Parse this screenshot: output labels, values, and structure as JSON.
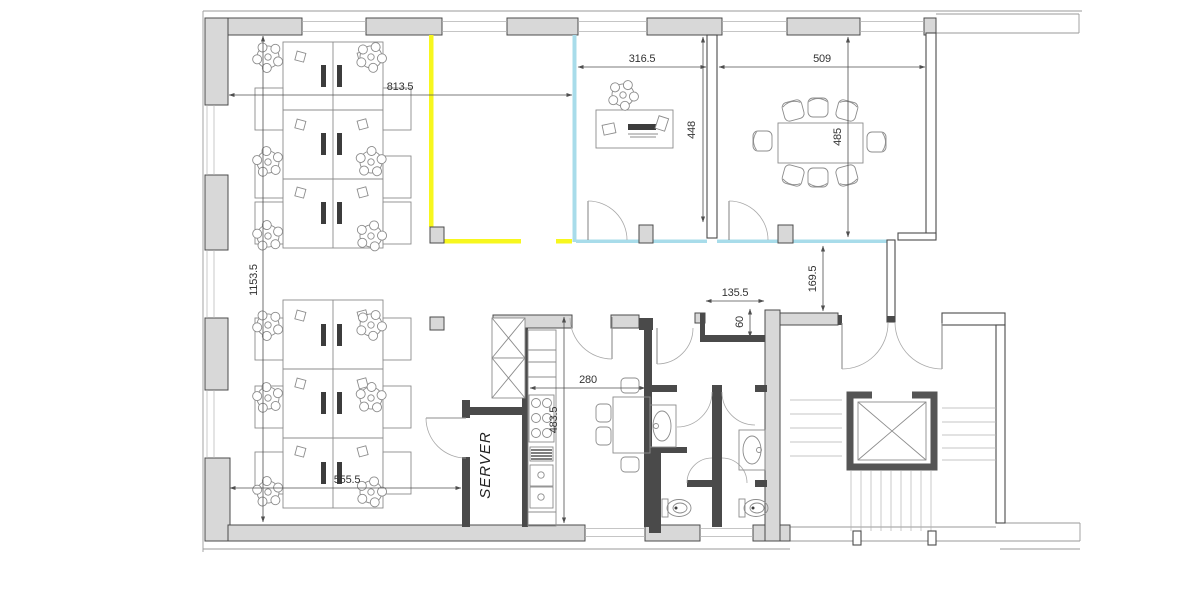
{
  "floor_plan": {
    "labels": {
      "server_room": "SERVER"
    },
    "colors": {
      "highlight_yellow": "#f7f71e",
      "highlight_cyan": "#a8dcea",
      "wall_fill": "#d8d8d8",
      "wall_stroke": "#4b4b4b",
      "dim_text": "#333333"
    },
    "dimensions": [
      {
        "id": "open-office-width",
        "text": "813.5"
      },
      {
        "id": "open-office-depth",
        "text": "1153.5"
      },
      {
        "id": "office-lower-width",
        "text": "555.5"
      },
      {
        "id": "private-office-width",
        "text": "316.5"
      },
      {
        "id": "meeting-room-width",
        "text": "509"
      },
      {
        "id": "private-office-depth",
        "text": "448"
      },
      {
        "id": "meeting-room-depth",
        "text": "485"
      },
      {
        "id": "corridor-width",
        "text": "169.5"
      },
      {
        "id": "niche-width",
        "text": "135.5"
      },
      {
        "id": "niche-depth",
        "text": "60"
      },
      {
        "id": "kitchen-width",
        "text": "280"
      },
      {
        "id": "kitchen-depth",
        "text": "483.5"
      }
    ]
  }
}
